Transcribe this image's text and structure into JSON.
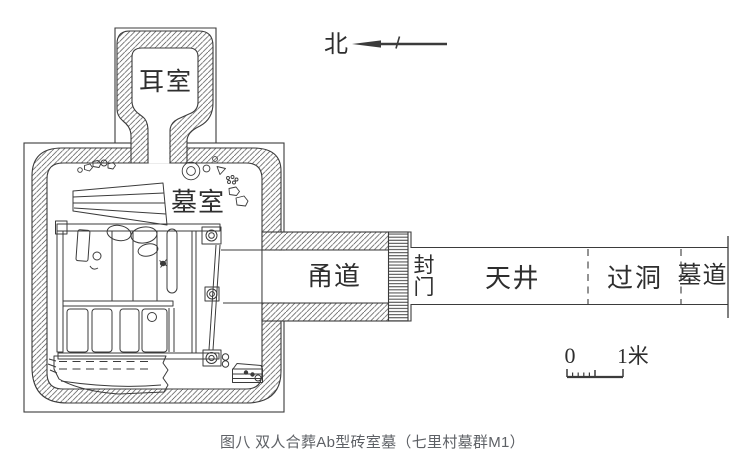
{
  "figure_caption": "图八 双人合葬Ab型砖室墓（七里村墓群M1）",
  "compass": {
    "north_label": "北"
  },
  "scale_bar": {
    "zero": "0",
    "one_meter": "1米"
  },
  "plan_labels": {
    "ear_chamber": "耳室",
    "burial_chamber": "墓室",
    "corridor": "甬道",
    "sealed_door": "封门",
    "sealed_door_chars": [
      "封",
      "门"
    ],
    "courtyard": "天井",
    "passage_tunnel": "过洞",
    "tomb_ramp": "墓道"
  },
  "colors": {
    "line": "#3b3b3b",
    "caption": "#5e6166",
    "background": "#ffffff"
  }
}
